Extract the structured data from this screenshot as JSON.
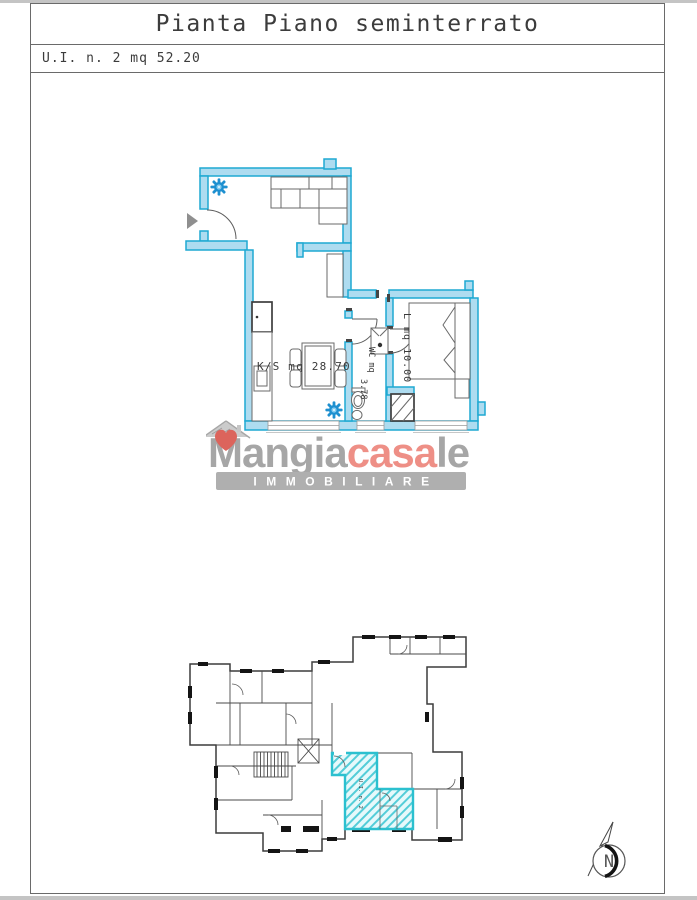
{
  "header": {
    "title": "Pianta Piano seminterrato",
    "subtitle": "U.I. n. 2 mq 52.20"
  },
  "main_plan": {
    "labels": {
      "kitchen_living": "K/S mq 28.70",
      "bedroom": "L mq 10.00",
      "wc_name": "WC mq",
      "wc_area": "3.78"
    }
  },
  "overview_plan": {
    "unit_label": "U.I. n. 2"
  },
  "watermark": {
    "name_part1": "Mangia",
    "name_part2": "casa",
    "name_part3": "le",
    "tagline": "IMMOBILIARE"
  },
  "north_indicator": {
    "letter": "N"
  },
  "colors": {
    "wall_fill": "#aedcf0",
    "wall_stroke": "#1fa9d2",
    "radiator": "#1e90d0",
    "unit_fill": "#e6f9fb",
    "unit_stroke": "#2bc0cf",
    "unit_hatch": "#54cdd8",
    "brand_gray": "#9a9a9a",
    "brand_red": "#ec8076",
    "heart_red": "#d84f46",
    "bar_gray": "#a5a5a5",
    "line_dark": "#3c3c3c",
    "furniture": "#6a6a6a"
  }
}
